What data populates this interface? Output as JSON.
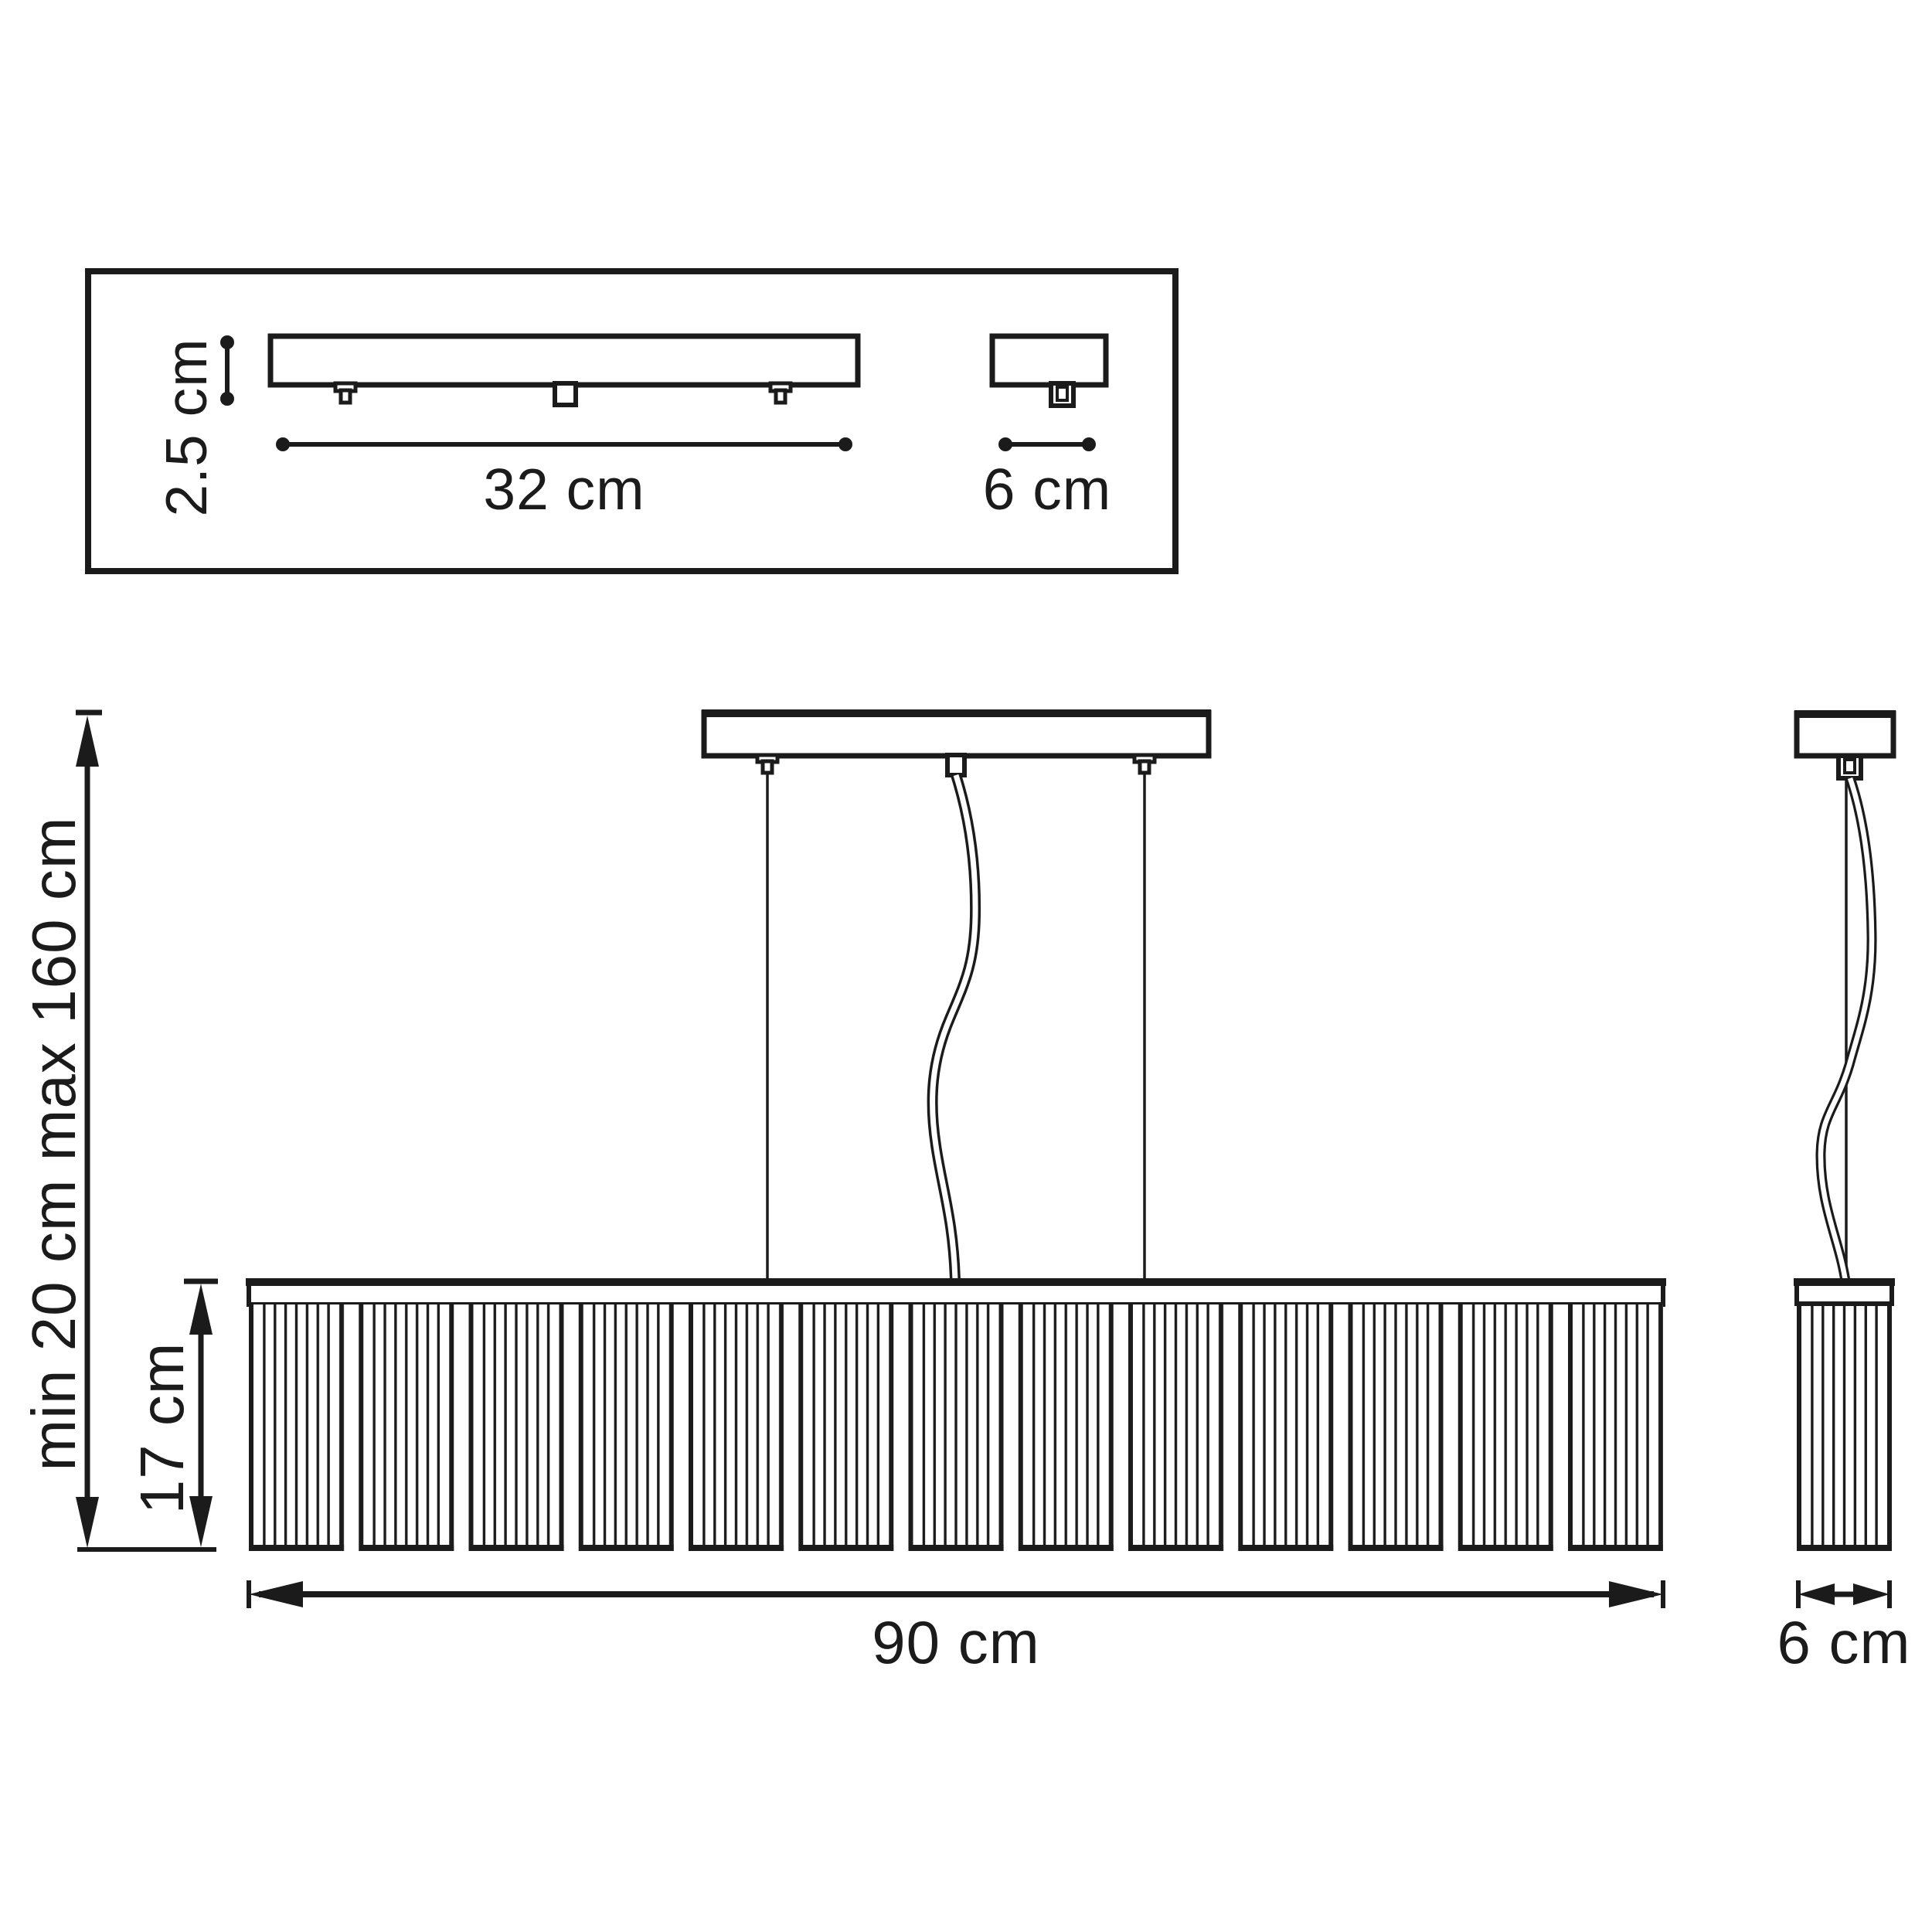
{
  "labels": {
    "canopy_thickness": "2.5 cm",
    "canopy_length": "32 cm",
    "canopy_depth": "6 cm",
    "suspension_height": "min 20 cm max 160 cm",
    "shade_height": "17 cm",
    "fixture_width": "90 cm",
    "fixture_depth": "6 cm"
  },
  "colors": {
    "line": "#1b1b1b",
    "background": "#ffffff"
  },
  "structure": {
    "shade_sections": 13,
    "rods_per_section": 7,
    "suspension_wires": 2,
    "power_cords": 1
  }
}
